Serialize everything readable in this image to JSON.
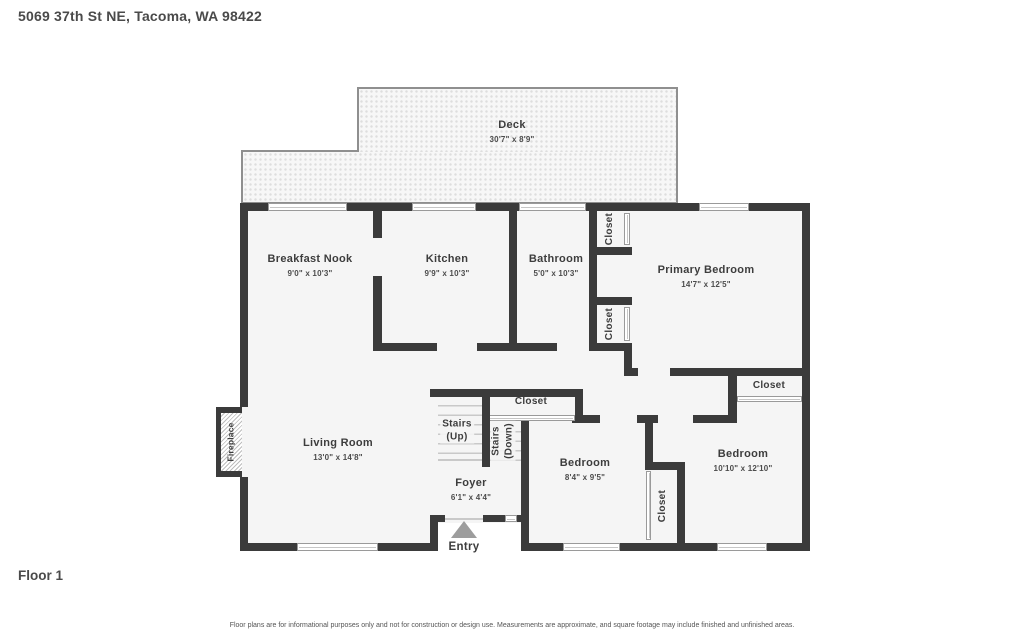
{
  "header": {
    "address": "5069 37th St NE, Tacoma, WA 98422"
  },
  "floor": {
    "label": "Floor 1"
  },
  "disclaimer": "Floor plans are for informational purposes only and not for construction or design use. Measurements are approximate, and square footage may include finished and unfinished areas.",
  "colors": {
    "wall": "#3b3b3b",
    "floor_fill": "#f5f5f5",
    "deck_border": "#8f8f8f",
    "label_text": "#3d3d3d"
  },
  "rooms": {
    "deck": {
      "name": "Deck",
      "dims": "30'7\" x 8'9\""
    },
    "breakfast_nook": {
      "name": "Breakfast Nook",
      "dims": "9'0\" x 10'3\""
    },
    "kitchen": {
      "name": "Kitchen",
      "dims": "9'9\" x 10'3\""
    },
    "bathroom": {
      "name": "Bathroom",
      "dims": "5'0\" x 10'3\""
    },
    "primary_bedroom": {
      "name": "Primary Bedroom",
      "dims": "14'7\" x 12'5\""
    },
    "living_room": {
      "name": "Living Room",
      "dims": "13'0\" x 14'8\""
    },
    "foyer": {
      "name": "Foyer",
      "dims": "6'1\" x 4'4\""
    },
    "bedroom_small": {
      "name": "Bedroom",
      "dims": "8'4\" x 9'5\""
    },
    "bedroom_large": {
      "name": "Bedroom",
      "dims": "10'10\" x 12'10\""
    }
  },
  "features": {
    "closet": "Closet",
    "stairs_up_line1": "Stairs",
    "stairs_up_line2": "(Up)",
    "stairs_down_line1": "Stairs",
    "stairs_down_line2": "(Down)",
    "fireplace": "Fireplace",
    "entry": "Entry"
  }
}
